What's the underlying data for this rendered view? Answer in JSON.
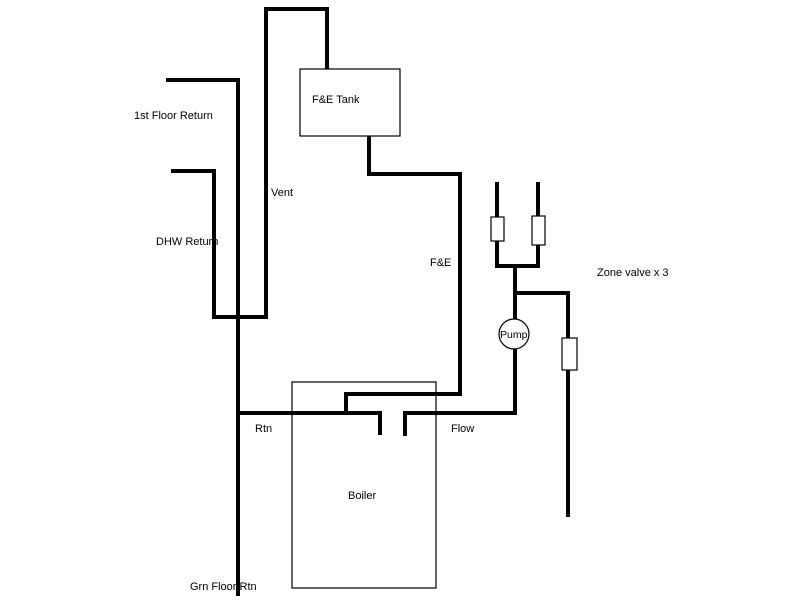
{
  "diagram": {
    "background_color": "#ffffff",
    "line_color": "#000000",
    "labels": {
      "first_floor_return": "1st Floor Return",
      "dhw_return": "DHW Return",
      "vent": "Vent",
      "fe_tank": "F&E Tank",
      "fe_pipe": "F&E",
      "zone_valve": "Zone valve x 3",
      "pump": "Pump",
      "rtn": "Rtn",
      "flow": "Flow",
      "boiler": "Boiler",
      "grn_floor_rtn": "Grn Floor Rtn"
    }
  }
}
